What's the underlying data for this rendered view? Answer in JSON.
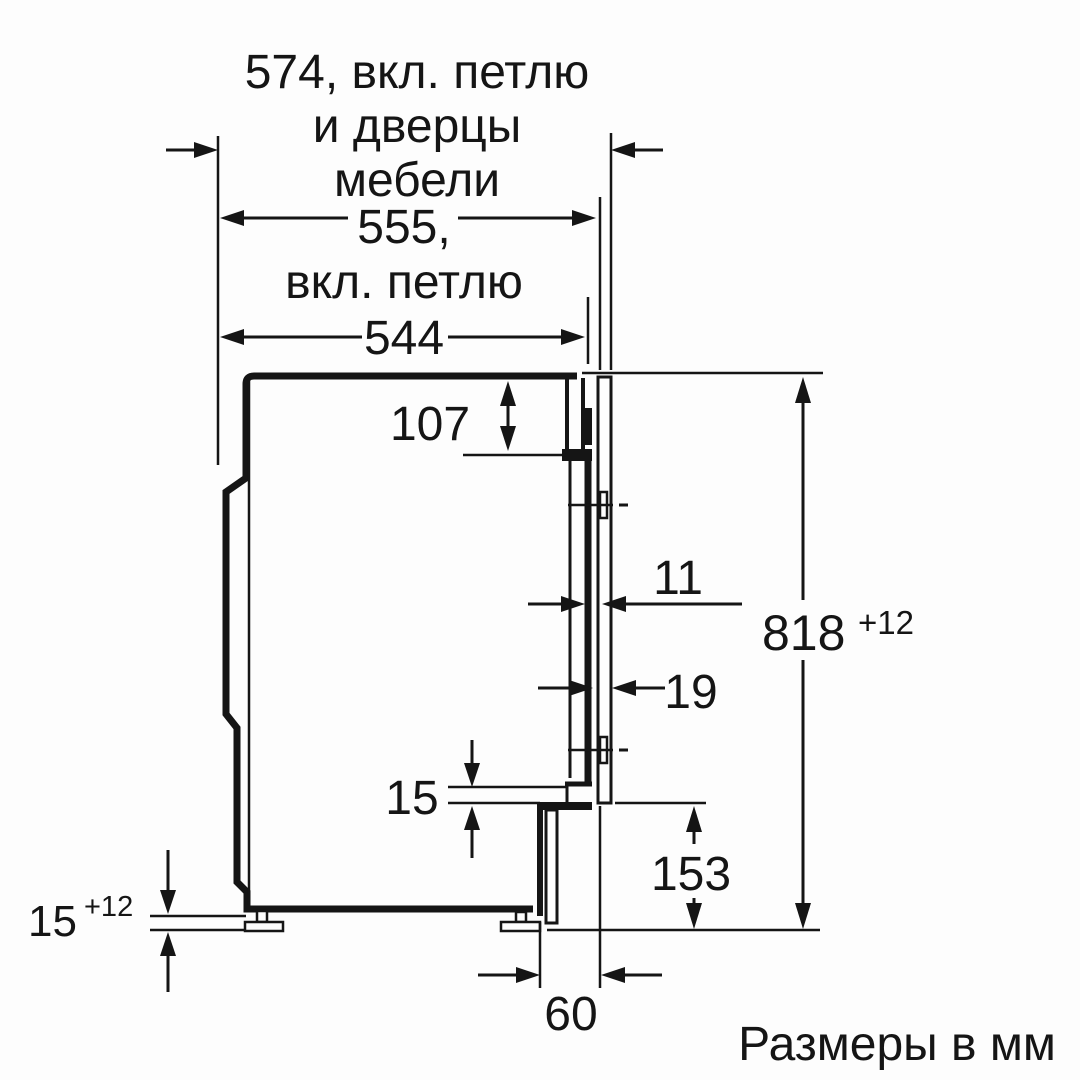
{
  "caption": "Размеры в мм",
  "dimensions": {
    "depth_incl_hinge_and_furniture_door": {
      "line1": "574, вкл. петлю",
      "line2": "и дверцы",
      "line3": "мебели"
    },
    "depth_incl_hinge": {
      "line1": "555,",
      "line2": "вкл. петлю"
    },
    "appliance_depth": "544",
    "top_recess": "107",
    "door_gap": "11",
    "furniture_door_thickness": "19",
    "niche_height": {
      "value": "818",
      "tolerance": "+12"
    },
    "panel_bottom_clearance": "153",
    "lower_overlap": "15",
    "foot_adjustment": {
      "value": "15",
      "tolerance": "+12"
    },
    "plinth_recess": "60"
  }
}
